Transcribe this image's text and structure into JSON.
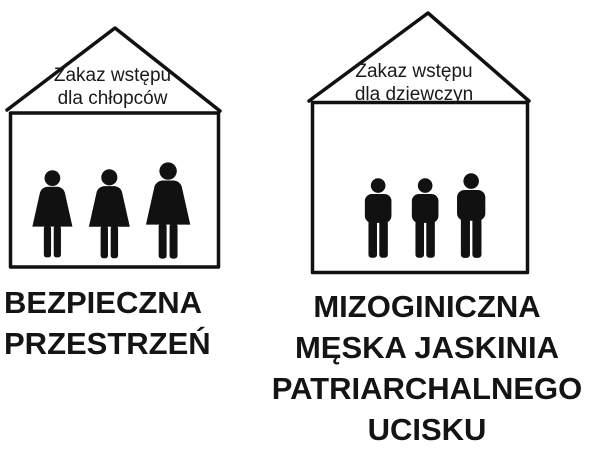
{
  "left_house": {
    "roof_label": "Zakaz wstępu\ndla chłopców",
    "caption": "BEZPIECZNA\nPRZESTRZEŃ",
    "occupant_icon": "woman-icon",
    "occupant_count": 3
  },
  "right_house": {
    "roof_label": "Zakaz wstępu\ndla dziewczyn",
    "caption": "MIZOGINICZNA\nMĘSKA JASKINIA\nPATRIARCHALNEGO\nUCISKU",
    "occupant_icon": "man-icon",
    "occupant_count": 3
  },
  "colors": {
    "ink": "#111111",
    "background": "#ffffff"
  }
}
